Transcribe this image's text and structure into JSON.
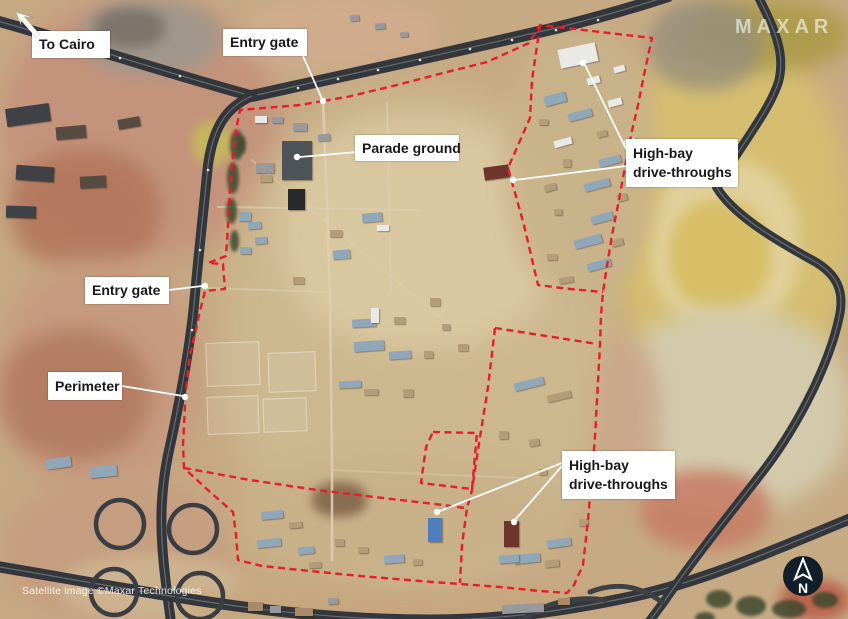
{
  "watermarks": {
    "logo": "MAXAR",
    "credit": "Satellite image ©Maxar Technologies",
    "north_label": "N"
  },
  "colors": {
    "annotation_red": "#e91c2c",
    "leader_white": "#ffffff",
    "label_bg": "#ffffff",
    "label_text": "#191919",
    "road_dark": "#33373c",
    "north_circle_bg": "#131e2b"
  },
  "labels": [
    {
      "id": "to-cairo",
      "line1": "To Cairo",
      "line2": "",
      "box": {
        "x": 32,
        "y": 31,
        "w": 78,
        "h": 27
      },
      "leaders": [],
      "dots": []
    },
    {
      "id": "entry-gate-top",
      "line1": "Entry gate",
      "line2": "",
      "box": {
        "x": 223,
        "y": 29,
        "w": 84,
        "h": 27
      },
      "leaders": [
        {
          "x1": 303,
          "y1": 56,
          "x2": 322,
          "y2": 99
        }
      ],
      "dots": [
        {
          "x": 323,
          "y": 101
        }
      ]
    },
    {
      "id": "parade-ground",
      "line1": "Parade ground",
      "line2": "",
      "box": {
        "x": 355,
        "y": 135,
        "w": 104,
        "h": 26
      },
      "leaders": [
        {
          "x1": 357,
          "y1": 152,
          "x2": 300,
          "y2": 157
        }
      ],
      "dots": [
        {
          "x": 297,
          "y": 157
        }
      ]
    },
    {
      "id": "high-bay-top",
      "line1": "High-bay",
      "line2": "drive-throughs",
      "box": {
        "x": 626,
        "y": 139,
        "w": 112,
        "h": 48
      },
      "leaders": [
        {
          "x1": 626,
          "y1": 149,
          "x2": 585,
          "y2": 65
        },
        {
          "x1": 626,
          "y1": 166,
          "x2": 515,
          "y2": 180
        }
      ],
      "dots": [
        {
          "x": 583,
          "y": 63
        },
        {
          "x": 513,
          "y": 180
        }
      ]
    },
    {
      "id": "entry-gate-left",
      "line1": "Entry gate",
      "line2": "",
      "box": {
        "x": 85,
        "y": 277,
        "w": 84,
        "h": 27
      },
      "leaders": [
        {
          "x1": 169,
          "y1": 290,
          "x2": 202,
          "y2": 286
        }
      ],
      "dots": [
        {
          "x": 205,
          "y": 286
        }
      ]
    },
    {
      "id": "perimeter",
      "line1": "Perimeter",
      "line2": "",
      "box": {
        "x": 48,
        "y": 372,
        "w": 74,
        "h": 28
      },
      "leaders": [
        {
          "x1": 122,
          "y1": 386,
          "x2": 183,
          "y2": 396
        }
      ],
      "dots": [
        {
          "x": 185,
          "y": 397
        }
      ]
    },
    {
      "id": "high-bay-bottom",
      "line1": "High-bay",
      "line2": "drive-throughs",
      "box": {
        "x": 562,
        "y": 451,
        "w": 113,
        "h": 48
      },
      "leaders": [
        {
          "x1": 562,
          "y1": 463,
          "x2": 440,
          "y2": 511
        },
        {
          "x1": 562,
          "y1": 466,
          "x2": 515,
          "y2": 520
        }
      ],
      "dots": [
        {
          "x": 437,
          "y": 512
        },
        {
          "x": 514,
          "y": 522
        }
      ]
    }
  ],
  "perimeter_paths": {
    "main": "M 323,101 L 300,105 L 270,107.5 L 240,110 L 236,130 L 233,155 L 230,190 L 228,225 L 226,256 L 208,263 L 223,264 L 225,289 L 205,291 L 199,315 L 196,330 L 190,355 L 188,372 L 186,390 L 185,405 L 183,445 L 184,468 L 210,492 L 233,512 L 236,535 L 238,560 L 262,566 L 300,570 L 360,576 L 420,581 L 460,584 L 500,587 L 540,591 L 567,593 L 574,585 L 583,565 L 588,520 L 592,473 L 595,437 L 597,400 L 600,345 L 601,315 L 603,292 L 606,272 L 612,235 L 618,205 L 625,167 L 631,135 L 638,105 L 645,70 L 652,38 L 540,25 L 529,43 L 487,62 L 443,73 L 397,85 L 347,97 Z",
    "ne_inner": "M 540,25 L 532,80 L 530,118 L 508,168 L 524,225 L 538,285 L 570,289 L 603,292",
    "east_top": "M 495,328 L 540,335 L 597,344",
    "east_left": "M 495,328 L 488,387 L 480,437 L 472,490 L 467,508 L 462,545 L 460,583",
    "mid_divider": "M 184,468 L 250,480 L 317,490 L 383,498 L 443,505 L 465,508",
    "small_square": "M 433,432 L 477,433 L 472,489 L 421,483 L 426,447 Z"
  },
  "scenery": {
    "terrain": [
      [
        0,
        0,
        280,
        260,
        14,
        "#c4937c",
        1
      ],
      [
        10,
        150,
        150,
        120,
        10,
        "#b07257",
        0.8
      ],
      [
        80,
        0,
        140,
        75,
        8,
        "#9e978c",
        0.9
      ],
      [
        95,
        8,
        70,
        40,
        6,
        "#6e675e",
        0.7
      ],
      [
        240,
        0,
        200,
        70,
        12,
        "#d2ac8e",
        0.9
      ],
      [
        0,
        260,
        200,
        230,
        14,
        "#c69a7f",
        1
      ],
      [
        0,
        330,
        150,
        130,
        10,
        "#ad7258",
        0.7
      ],
      [
        0,
        480,
        230,
        140,
        14,
        "#c59d80",
        1
      ],
      [
        60,
        555,
        180,
        65,
        8,
        "#cfb894",
        0.8
      ],
      [
        615,
        40,
        235,
        370,
        14,
        "#d5bd70",
        1
      ],
      [
        650,
        160,
        150,
        170,
        8,
        "#e2d29e",
        0.9
      ],
      [
        670,
        200,
        100,
        110,
        6,
        "#d7bd62",
        0.9
      ],
      [
        690,
        0,
        160,
        70,
        10,
        "#ab9a47",
        0.9
      ],
      [
        650,
        0,
        110,
        90,
        8,
        "#968e7c",
        0.8
      ],
      [
        610,
        310,
        240,
        200,
        12,
        "#d3caac",
        1
      ],
      [
        640,
        470,
        130,
        80,
        8,
        "#c67f67",
        0.9
      ],
      [
        780,
        580,
        70,
        40,
        6,
        "#b95d48",
        0.9
      ],
      [
        180,
        585,
        500,
        35,
        8,
        "#c7a67e",
        0.9
      ],
      [
        225,
        90,
        385,
        490,
        16,
        "#ccb78f",
        1
      ],
      [
        280,
        120,
        280,
        230,
        14,
        "#dbc9a2",
        0.9
      ],
      [
        235,
        460,
        330,
        120,
        12,
        "#c8b189",
        0.9
      ],
      [
        505,
        30,
        150,
        265,
        10,
        "#c9b38b",
        0.9
      ],
      [
        312,
        482,
        55,
        35,
        5,
        "#7f6148",
        0.85
      ],
      [
        600,
        340,
        60,
        160,
        10,
        "#c9a187",
        0.8
      ],
      [
        192,
        120,
        40,
        45,
        5,
        "#c5bd55",
        0.8
      ]
    ],
    "ghosts": [
      [
        206,
        342,
        54,
        44
      ],
      [
        268,
        352,
        48,
        40
      ],
      [
        207,
        396,
        52,
        38
      ],
      [
        263,
        398,
        44,
        34
      ]
    ],
    "roads": [
      {
        "d": "M -6,20 C 80,44 170,74 252,96",
        "w": 11
      },
      {
        "d": "M 252,96 C 360,72 480,46 560,27 C 600,17 635,7 668,-4",
        "w": 12
      },
      {
        "d": "M 252,96 C 224,108 213,130 208,165 C 203,215 198,260 194,305 C 189,355 178,410 168,455 C 161,490 160,520 163,555 C 165,580 168,600 171,622",
        "w": 10
      },
      {
        "d": "M -6,566 C 60,577 140,592 215,603 C 290,614 360,620 430,620 C 500,620 565,611 635,596 C 700,582 770,552 852,518",
        "w": 11
      },
      {
        "d": "M 757,-6 C 772,25 786,50 779,80 C 770,112 736,150 717,188 C 733,214 772,238 812,260 C 838,274 845,292 839,318 C 830,360 802,420 764,470 C 737,505 700,550 663,603 C 655,614 650,620 646,626",
        "w": 9
      }
    ],
    "ramps": [
      "M 663,603 C 640,585 615,582 590,592",
      "M 520,621 C 545,602 575,596 605,600"
    ],
    "loops": [
      [
        120,
        524,
        24
      ],
      [
        193,
        529,
        24
      ],
      [
        114,
        592,
        23
      ],
      [
        200,
        596,
        23
      ]
    ],
    "tracks": [
      {
        "d": "M 323,100 L 327,205 L 330,300 L 332,470 L 332,560",
        "w": 2.5,
        "o": 0.9
      },
      {
        "d": "M 218,207 L 420,210",
        "w": 2,
        "o": 0.7
      },
      {
        "d": "M 387,103 L 391,292",
        "w": 2,
        "o": 0.7
      },
      {
        "d": "M 252,160 L 455,330",
        "w": 2,
        "o": 0.45
      },
      {
        "d": "M 332,470 L 520,478",
        "w": 2,
        "o": 0.45
      },
      {
        "d": "M 205,288 L 330,292",
        "w": 2,
        "o": 0.5
      }
    ],
    "road_dots": [
      [
        298,
        88
      ],
      [
        338,
        79
      ],
      [
        378,
        70
      ],
      [
        420,
        60
      ],
      [
        470,
        49
      ],
      [
        512,
        40
      ],
      [
        556,
        30
      ],
      [
        598,
        20
      ],
      [
        60,
        40
      ],
      [
        120,
        58
      ],
      [
        180,
        76
      ],
      [
        208,
        170
      ],
      [
        200,
        250
      ],
      [
        192,
        330
      ]
    ],
    "building_colors": {
      "W": "#e9eae6",
      "B": "#8fa7b8",
      "T": "#b59c78",
      "D": "#4e5357",
      "K": "#26292c",
      "R": "#6e352a",
      "BL": "#4d7fbe",
      "G": "#97999c",
      "K2": "#3f4146",
      "K3": "#564c42",
      "T2": "#a8896a"
    },
    "buildings": [
      [
        282,
        141,
        30,
        39,
        0,
        "D"
      ],
      [
        288,
        189,
        17,
        21,
        0,
        "K"
      ],
      [
        255,
        116,
        12,
        7,
        0,
        "W"
      ],
      [
        272,
        117,
        11,
        6,
        0,
        "G"
      ],
      [
        293,
        123,
        14,
        8,
        0,
        "G"
      ],
      [
        318,
        134,
        12,
        7,
        -5,
        "G"
      ],
      [
        256,
        163,
        18,
        10,
        0,
        "G"
      ],
      [
        260,
        175,
        12,
        7,
        0,
        "T"
      ],
      [
        239,
        212,
        12,
        9,
        0,
        "B"
      ],
      [
        248,
        222,
        13,
        7,
        -5,
        "B"
      ],
      [
        255,
        237,
        12,
        7,
        -5,
        "B"
      ],
      [
        240,
        247,
        11,
        7,
        0,
        "B"
      ],
      [
        362,
        213,
        20,
        9,
        -5,
        "B"
      ],
      [
        377,
        225,
        12,
        6,
        0,
        "W"
      ],
      [
        330,
        230,
        12,
        7,
        0,
        "T"
      ],
      [
        333,
        250,
        17,
        9,
        -5,
        "B"
      ],
      [
        293,
        277,
        11,
        7,
        0,
        "T"
      ],
      [
        352,
        319,
        24,
        8,
        -3,
        "B"
      ],
      [
        371,
        308,
        8,
        15,
        0,
        "W"
      ],
      [
        394,
        317,
        11,
        7,
        0,
        "T"
      ],
      [
        354,
        341,
        30,
        10,
        -4,
        "B"
      ],
      [
        389,
        351,
        22,
        8,
        -4,
        "B"
      ],
      [
        424,
        351,
        9,
        7,
        0,
        "T"
      ],
      [
        339,
        381,
        22,
        7,
        -3,
        "B"
      ],
      [
        364,
        389,
        14,
        6,
        0,
        "T"
      ],
      [
        403,
        389,
        10,
        8,
        0,
        "T"
      ],
      [
        442,
        324,
        8,
        6,
        0,
        "T"
      ],
      [
        458,
        344,
        10,
        7,
        0,
        "T"
      ],
      [
        430,
        298,
        10,
        8,
        0,
        "T"
      ],
      [
        261,
        511,
        22,
        8,
        -5,
        "B"
      ],
      [
        289,
        522,
        13,
        6,
        -5,
        "T"
      ],
      [
        257,
        539,
        24,
        8,
        -6,
        "B"
      ],
      [
        298,
        547,
        16,
        7,
        -6,
        "B"
      ],
      [
        335,
        539,
        9,
        7,
        0,
        "T"
      ],
      [
        309,
        562,
        12,
        6,
        -4,
        "T"
      ],
      [
        358,
        547,
        10,
        6,
        0,
        "T"
      ],
      [
        384,
        555,
        20,
        8,
        -5,
        "B"
      ],
      [
        413,
        559,
        9,
        6,
        0,
        "T"
      ],
      [
        428,
        518,
        14,
        24,
        0,
        "BL"
      ],
      [
        504,
        521,
        15,
        26,
        0,
        "R"
      ],
      [
        514,
        554,
        26,
        9,
        -6,
        "B"
      ],
      [
        545,
        560,
        14,
        7,
        -6,
        "T"
      ],
      [
        514,
        380,
        30,
        8,
        -14,
        "B"
      ],
      [
        547,
        393,
        24,
        7,
        -14,
        "T"
      ],
      [
        499,
        431,
        9,
        8,
        0,
        "T"
      ],
      [
        529,
        439,
        10,
        7,
        -10,
        "T"
      ],
      [
        574,
        464,
        10,
        9,
        0,
        "B"
      ],
      [
        539,
        469,
        8,
        6,
        0,
        "T"
      ],
      [
        499,
        555,
        20,
        8,
        -5,
        "B"
      ],
      [
        547,
        539,
        24,
        8,
        -8,
        "B"
      ],
      [
        579,
        519,
        9,
        7,
        0,
        "T"
      ],
      [
        559,
        46,
        38,
        19,
        -12,
        "W"
      ],
      [
        544,
        94,
        22,
        10,
        -15,
        "B"
      ],
      [
        587,
        77,
        13,
        7,
        -15,
        "W"
      ],
      [
        614,
        66,
        11,
        6,
        -15,
        "W"
      ],
      [
        568,
        111,
        24,
        8,
        -15,
        "B"
      ],
      [
        608,
        99,
        14,
        7,
        -15,
        "W"
      ],
      [
        539,
        119,
        9,
        6,
        0,
        "T"
      ],
      [
        554,
        139,
        18,
        7,
        -15,
        "W"
      ],
      [
        597,
        131,
        10,
        6,
        -15,
        "T"
      ],
      [
        624,
        139,
        12,
        7,
        -15,
        "W"
      ],
      [
        484,
        166,
        25,
        13,
        -8,
        "R"
      ],
      [
        599,
        157,
        22,
        8,
        -15,
        "B"
      ],
      [
        629,
        169,
        10,
        6,
        -15,
        "T"
      ],
      [
        563,
        159,
        8,
        8,
        0,
        "T"
      ],
      [
        544,
        184,
        12,
        7,
        -15,
        "T"
      ],
      [
        584,
        181,
        26,
        8,
        -15,
        "B"
      ],
      [
        617,
        194,
        10,
        7,
        -15,
        "T"
      ],
      [
        554,
        209,
        8,
        6,
        0,
        "T"
      ],
      [
        591,
        214,
        22,
        8,
        -15,
        "B"
      ],
      [
        574,
        237,
        28,
        9,
        -15,
        "B"
      ],
      [
        611,
        239,
        12,
        7,
        -15,
        "T"
      ],
      [
        547,
        254,
        10,
        6,
        0,
        "T"
      ],
      [
        587,
        261,
        24,
        8,
        -15,
        "B"
      ],
      [
        559,
        277,
        14,
        6,
        -10,
        "T"
      ],
      [
        6,
        106,
        44,
        18,
        -8,
        "K2"
      ],
      [
        56,
        126,
        30,
        13,
        -5,
        "K3"
      ],
      [
        16,
        166,
        38,
        15,
        4,
        "K2"
      ],
      [
        80,
        176,
        26,
        12,
        -3,
        "K3"
      ],
      [
        6,
        206,
        30,
        12,
        2,
        "K2"
      ],
      [
        118,
        118,
        22,
        10,
        -10,
        "K3"
      ],
      [
        46,
        458,
        25,
        10,
        -8,
        "B"
      ],
      [
        90,
        466,
        27,
        11,
        -6,
        "B"
      ],
      [
        350,
        15,
        9,
        6,
        -5,
        "G"
      ],
      [
        375,
        23,
        10,
        6,
        -5,
        "G"
      ],
      [
        400,
        32,
        8,
        5,
        -5,
        "G"
      ],
      [
        248,
        602,
        15,
        9,
        0,
        "T2"
      ],
      [
        270,
        606,
        11,
        7,
        0,
        "G"
      ],
      [
        295,
        608,
        18,
        8,
        0,
        "T2"
      ],
      [
        328,
        598,
        10,
        6,
        0,
        "G"
      ],
      [
        502,
        604,
        42,
        9,
        -3,
        "G"
      ],
      [
        558,
        598,
        12,
        7,
        0,
        "T2"
      ]
    ],
    "trees": [
      [
        230,
        130,
        14,
        30
      ],
      [
        227,
        162,
        12,
        32
      ],
      [
        226,
        198,
        11,
        26
      ],
      [
        230,
        230,
        9,
        22
      ],
      [
        238,
        136,
        8,
        18
      ],
      [
        706,
        590,
        26,
        18
      ],
      [
        736,
        596,
        30,
        20
      ],
      [
        772,
        600,
        34,
        18
      ],
      [
        812,
        592,
        26,
        16
      ],
      [
        695,
        612,
        20,
        12
      ]
    ]
  }
}
